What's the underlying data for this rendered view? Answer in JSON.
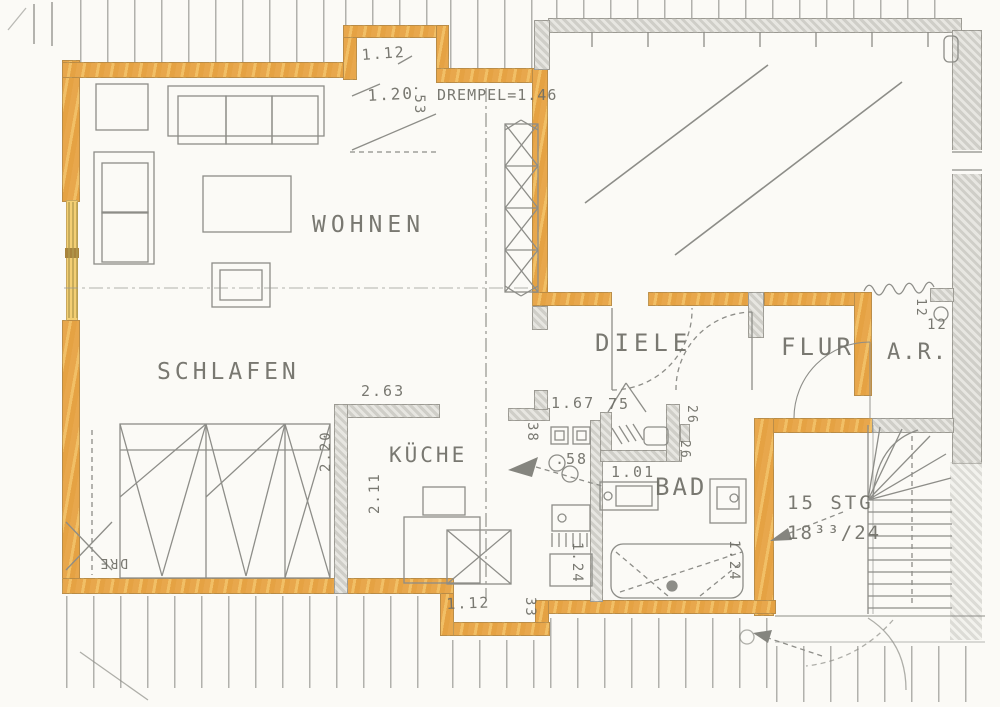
{
  "document": {
    "kind_label": "apartment floor plan (scanned, marked with orange highlighter)"
  },
  "rooms": {
    "wohnen": "WOHNEN",
    "schlafen": "SCHLAFEN",
    "kueche": "KÜCHE",
    "diele": "DIELE",
    "flur": "FLUR",
    "ar": "A.R.",
    "bad": "BAD"
  },
  "stairs": {
    "line1": "15 STG",
    "line2": "18³³/24"
  },
  "dimensions": {
    "dormer_width": "1.12",
    "dormer_53": ".53",
    "dormer_depth": "1.20",
    "drempel": "DREMPEL=1.46",
    "d263": "2.63",
    "d220": "2.20",
    "d211": "2.11",
    "d167": "1.67",
    "d75": "75",
    "d38": "38",
    "d58": ".58",
    "d101": "1.01",
    "d26a": "26",
    "d26b": "26",
    "d124a": "1.24",
    "d124b": "1.24",
    "d12a": "12",
    "d12b": "12",
    "bottom_bump_width": "1.12",
    "d33": "33",
    "dre_cutoff": "DRE"
  },
  "colors": {
    "highlight_orange": "#e8a74c",
    "highlight_window_yellow": "#f3cf74",
    "wall_gray": "#d6d5cf",
    "line_gray": "#8d8d88",
    "text_gray": "#6e6e66",
    "paper": "#fbfaf6"
  }
}
